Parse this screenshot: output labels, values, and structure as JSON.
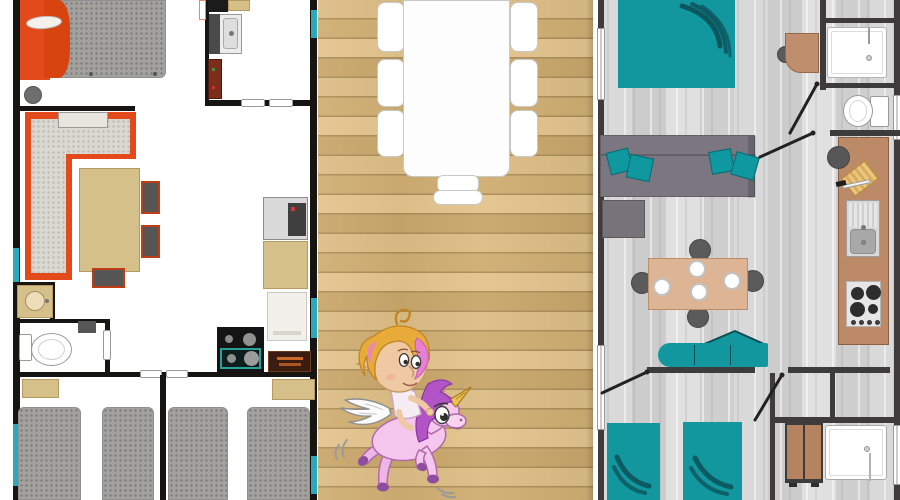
{
  "scene": {
    "left_panel": "floorplan-a",
    "center_panel": "wood-deck-terrace",
    "right_panel": "floorplan-b",
    "overlay_illustration": "fairy-riding-winged-unicorn"
  },
  "colors": {
    "wall_black": "#171512",
    "wall_gray": "#3d3b3c",
    "orange": "#e2491b",
    "orange_frame": "#c03c12",
    "mattress_gray": "#a3a19e",
    "cushion_gray": "#dbd8d2",
    "tan": "#d6c089",
    "tan_dark": "#b89a5e",
    "teal_window": "#2aa9bd",
    "teal_bed": "#12979e",
    "teal_dark": "#0c4f57",
    "teal_pillow": "#0f98a0",
    "deck_a": "#dcbd85",
    "deck_b": "#cfae72",
    "deck_c": "#e3c48d",
    "deck_d": "#c9a76b",
    "deck_gap": "#ab8d58",
    "floor_gray": "#d3d3d3",
    "sofa_gray": "#7b7680",
    "brown_counter": "#bc8a67",
    "brown_wardrobe": "#b5835f",
    "chair_gray": "#5b5b5b",
    "stove_black": "#141414",
    "oven_brown": "#3a1d10",
    "cabinet_red": "#7c2e1b",
    "unicorn_pink": "#f5c6ee",
    "mane_purple": "#b254c5",
    "hoof_purple": "#8e4d9e",
    "skin": "#efc9a2",
    "hair_gold": "#e8ab3a",
    "hair_pink": "#e87fd2",
    "horn_gold": "#ecc254"
  }
}
